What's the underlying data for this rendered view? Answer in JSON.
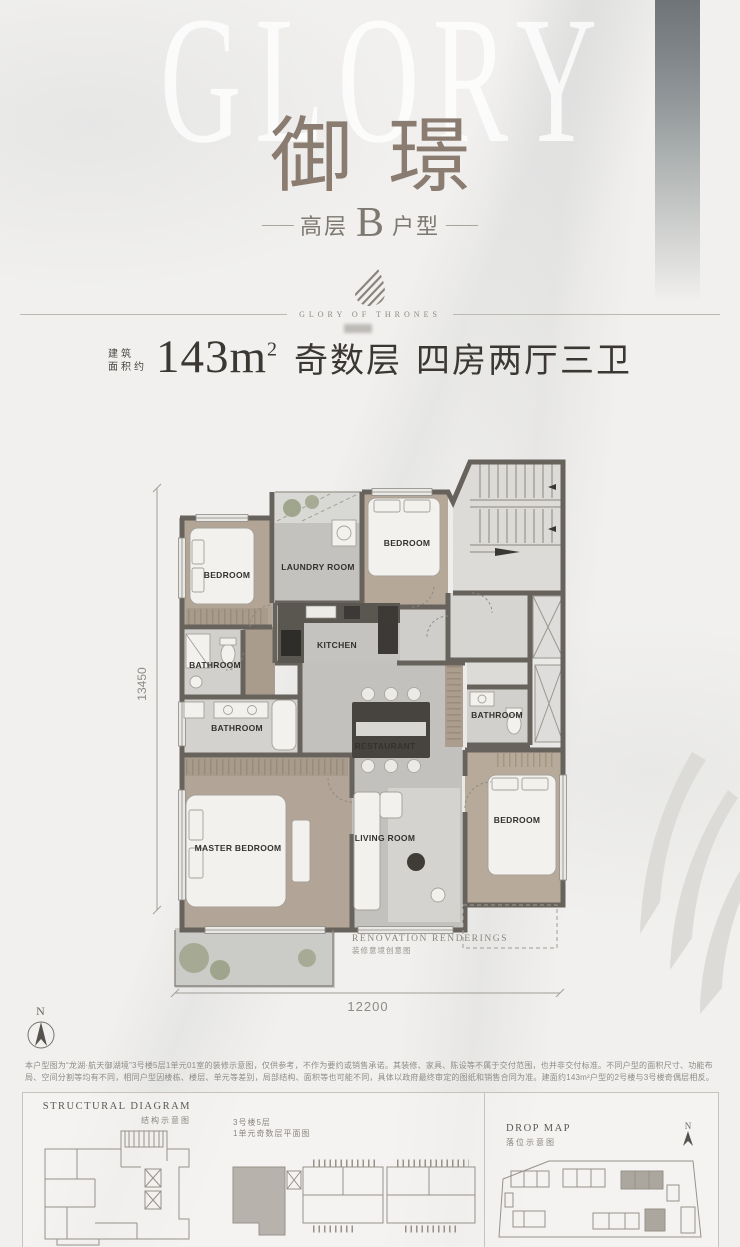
{
  "header": {
    "watermark": "GLORY",
    "title": "御璟",
    "subtitle": {
      "prefix": "高层",
      "letter": "B",
      "suffix": "户型"
    },
    "brand_line": "GLORY OF THRONES"
  },
  "spec": {
    "area_label_top": "建筑",
    "area_label_bottom": "面积约",
    "area_value": "143m",
    "area_exponent": "2",
    "floor_parity": "奇数层",
    "rooms_desc": "四房两厅三卫"
  },
  "floorplan": {
    "compass_label": "N",
    "dim_left": "13450",
    "dim_bottom": "12200",
    "note_en": "RENOVATION RENDERINGS",
    "note_cn": "装修意境创意图",
    "rooms": [
      "BEDROOM",
      "LAUNDRY ROOM",
      "BEDROOM",
      "BATHROOM",
      "KITCHEN",
      "BATHROOM",
      "RESTAURANT",
      "BATHROOM",
      "MASTER BEDROOM",
      "LIVING ROOM",
      "BEDROOM"
    ]
  },
  "disclaimer": "本户型图为“龙湖·航天御湖境”3号楼5层1单元01室的装修示意图，仅供参考，不作为要约或销售承诺。其装修、家具、陈设等不属于交付范围，也并非交付标准。不同户型的面积尺寸、功能布局、空间分割等均有不同，相同户型因楼栋、楼层、单元等差别，局部结构、面积等也可能不同，具体以政府最终审定的图纸和销售合同为准。建面约143m²户型的2号楼与3号楼奇偶层相反。",
  "footer": {
    "structural_title_en": "STRUCTURAL DIAGRAM",
    "structural_title_cn": "结构示意图",
    "middle_label_line1": "3号楼5层",
    "middle_label_line2": "1单元奇数层平面图",
    "dropmap_title_en": "DROP MAP",
    "dropmap_title_cn": "落位示意图",
    "compass_label": "N"
  },
  "colors": {
    "accent_brown": "#8b7c71",
    "wall": "#67635c",
    "wood_floor": "#b4a798",
    "tile_floor": "#c4c3c0",
    "page_bg": "#f1f0ee"
  }
}
